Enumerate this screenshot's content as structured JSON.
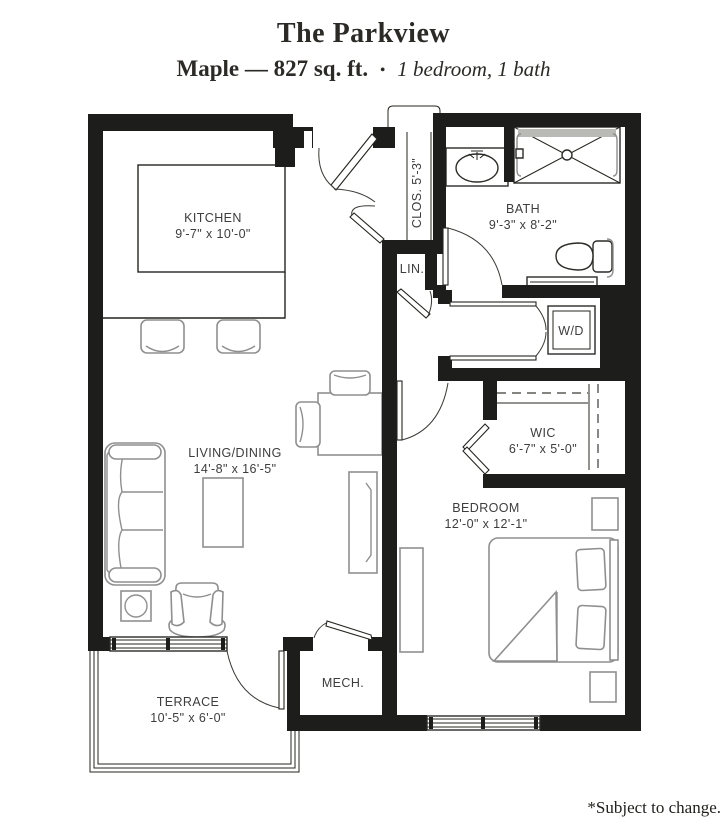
{
  "header": {
    "title": "The Parkview",
    "plan_name_sqft": "Maple — 827 sq. ft.",
    "separator": "•",
    "bed_bath": "1 bedroom, 1 bath"
  },
  "rooms": {
    "kitchen": {
      "name": "KITCHEN",
      "dims": "9'-7\" x 10'-0\""
    },
    "closet": {
      "name": "CLOS. 5'-3\""
    },
    "bath": {
      "name": "BATH",
      "dims": "9'-3\" x 8'-2\""
    },
    "linen": {
      "name": "LIN."
    },
    "washer_dryer": {
      "name": "W/D"
    },
    "living_dining": {
      "name": "LIVING/DINING",
      "dims": "14'-8\" x 16'-5\""
    },
    "wic": {
      "name": "WIC",
      "dims": "6'-7\" x 5'-0\""
    },
    "bedroom": {
      "name": "BEDROOM",
      "dims": "12'-0\" x 12'-1\""
    },
    "mech": {
      "name": "MECH."
    },
    "terrace": {
      "name": "TERRACE",
      "dims": "10'-5\" x 6'-0\""
    }
  },
  "footer": {
    "disclaimer": "*Subject to change."
  },
  "colors": {
    "wall": "#1d1d1b",
    "furniture": "#8f8f8f",
    "label": "#3d3d3d"
  }
}
